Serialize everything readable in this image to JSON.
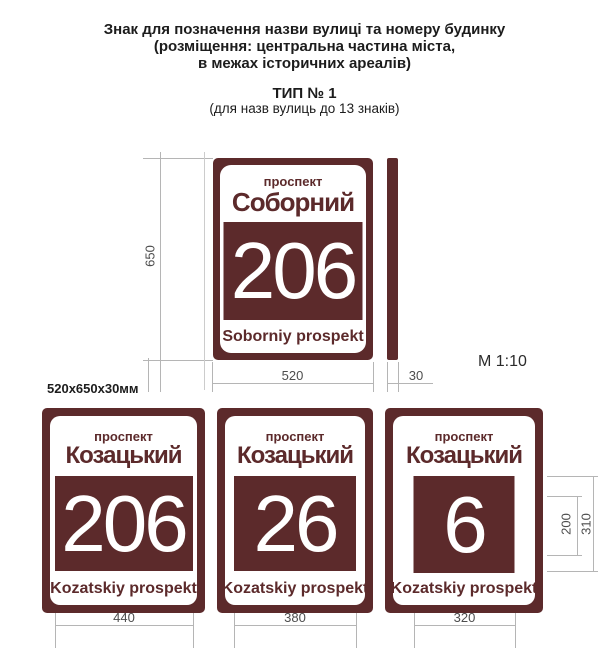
{
  "colors": {
    "sign_brown": "#5c2a2b",
    "dim_line": "#b5b5b5",
    "dim_text": "#4d4d4d",
    "title_text": "#1c1c1c"
  },
  "header": {
    "title_line1": "Знак для позначення назви вулиці та номеру будинку",
    "title_line2": "(розміщення: центральна частина міста,",
    "title_line3": "в межах історичних ареалів)",
    "type_label": "ТИП № 1",
    "type_note": "(для назв вулиць до 13 знаків)"
  },
  "scale_label": "М 1:10",
  "size_label": "520х650х30мм",
  "main_sign": {
    "street_type": "проспект",
    "street_name": "Соборний",
    "house_number": "206",
    "transliteration": "Soborniy prospekt",
    "height_dim": "650",
    "width_dim": "520",
    "depth_dim": "30"
  },
  "bottom_signs": [
    {
      "street_type": "проспект",
      "street_name": "Козацький",
      "house_number": "206",
      "transliteration": "Kozatskiy prospekt",
      "plate_width_dim": "440"
    },
    {
      "street_type": "проспект",
      "street_name": "Козацький",
      "house_number": "26",
      "transliteration": "Kozatskiy prospekt",
      "plate_width_dim": "380"
    },
    {
      "street_type": "проспект",
      "street_name": "Козацький",
      "house_number": "6",
      "transliteration": "Kozatskiy prospekt",
      "plate_width_dim": "320"
    }
  ],
  "side_dims": {
    "number_height": "200",
    "plate_height": "310"
  }
}
